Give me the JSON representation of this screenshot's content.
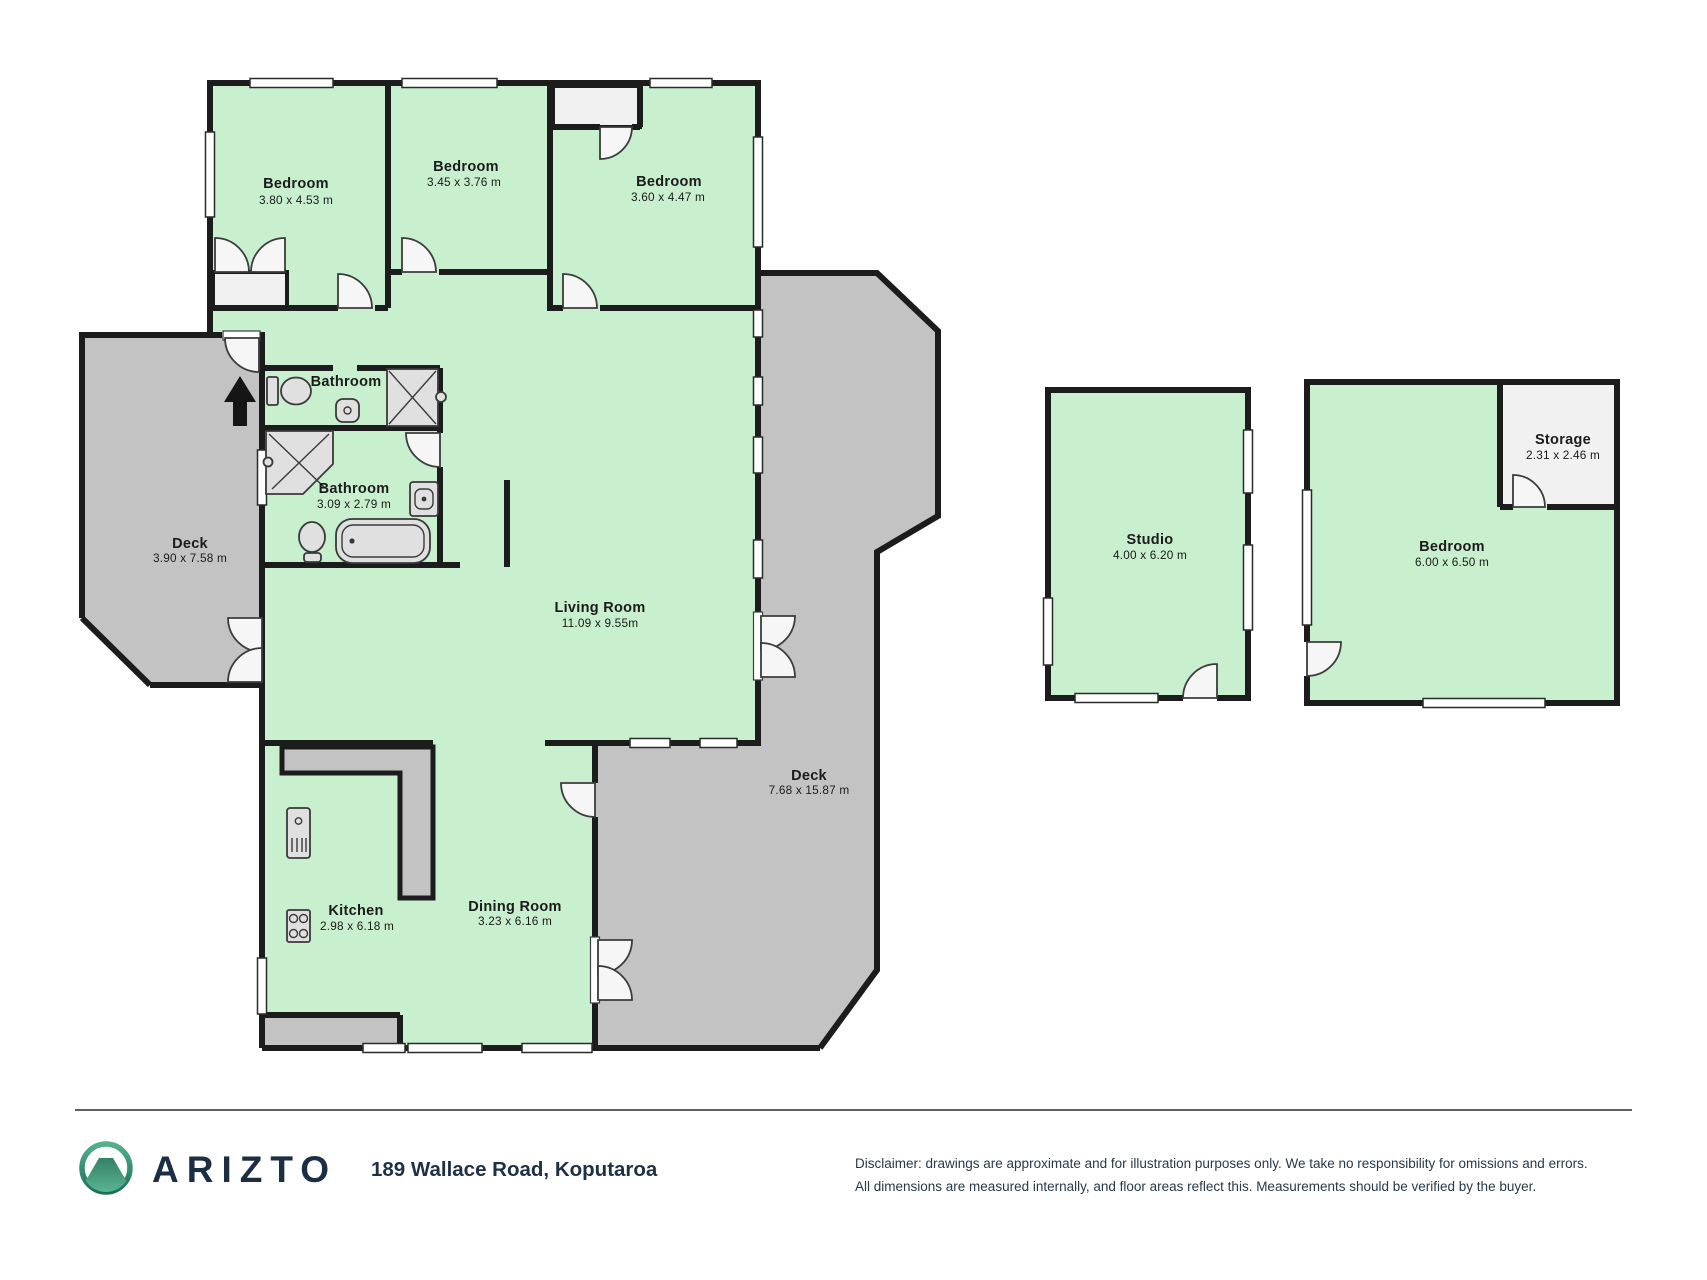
{
  "branding": {
    "logo_text": "ARIZTO",
    "address": "189 Wallace Road, Koputaroa"
  },
  "disclaimer": {
    "line1": "Disclaimer: drawings are approximate and for illustration purposes only. We take no responsibility for omissions and errors.",
    "line2": "All dimensions are measured internally, and floor areas reflect this. Measurements should be verified by the buyer."
  },
  "colors": {
    "floor_green": "#c8efce",
    "deck_gray": "#c3c3c3",
    "storage_white": "#f1f1f1",
    "wall": "#1c1c1c",
    "logo_teal": "#2e8b6e",
    "brand_navy": "#1c2e44"
  },
  "floorplan": {
    "bedroom1": {
      "name": "Bedroom",
      "dims": "3.80 x 4.53 m"
    },
    "bedroom2": {
      "name": "Bedroom",
      "dims": "3.45 x 3.76 m"
    },
    "bedroom3": {
      "name": "Bedroom",
      "dims": "3.60 x 4.47 m"
    },
    "bathroom1": {
      "name": "Bathroom"
    },
    "bathroom2": {
      "name": "Bathroom",
      "dims": "3.09 x 2.79 m"
    },
    "deck_left": {
      "name": "Deck",
      "dims": "3.90 x 7.58 m"
    },
    "living": {
      "name": "Living Room",
      "dims": "11.09 x 9.55m"
    },
    "deck_right": {
      "name": "Deck",
      "dims": "7.68 x 15.87 m"
    },
    "kitchen": {
      "name": "Kitchen",
      "dims": "2.98 x 6.18 m"
    },
    "dining": {
      "name": "Dining Room",
      "dims": "3.23 x 6.16 m"
    },
    "studio": {
      "name": "Studio",
      "dims": "4.00 x 6.20 m"
    },
    "storage": {
      "name": "Storage",
      "dims": "2.31 x 2.46 m"
    },
    "bedroom4": {
      "name": "Bedroom",
      "dims": "6.00 x 6.50 m"
    }
  }
}
